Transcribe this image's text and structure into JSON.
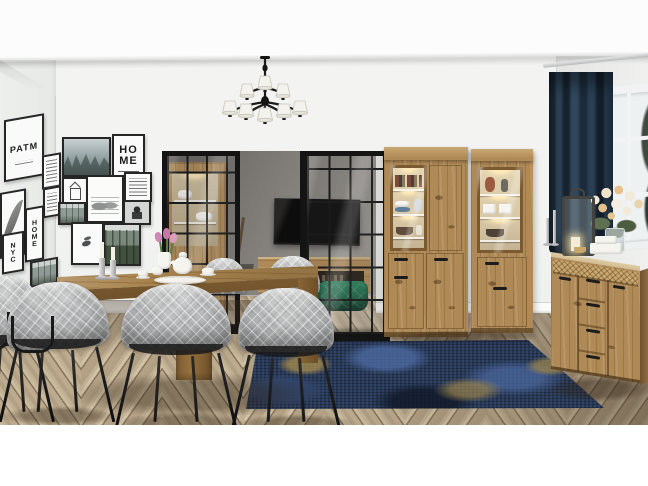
{
  "meta": {
    "description": "Interior product photo: dining room with oak furniture set, black-framed gallery wall, black chandelier with white shades, industrial glass partition to a TV room, dining table with tea set and grey quilted chairs, two lit oak display cabinets, oak chest of drawers with decor, navy velvet curtain, white window and blue vintage rug on herringbone oak floor.",
    "texts_visible": [
      "PATM",
      "HO ME",
      "H O M E",
      "N Y C"
    ]
  },
  "palette": {
    "ceiling": "#fcfcfc",
    "band": "#cfd0ce",
    "wall": "#f3f4f2",
    "wall_left": "#edefec",
    "wall_right": "#e9eae8",
    "back_wall": "#7d7a76",
    "back_floor": "#c0ac8c",
    "wood": "#b08a56",
    "wood_light": "#c8a873",
    "wood_dark": "#7c5a31",
    "wood_side": "#8f6c42",
    "wood_interior": "#d8c8a6",
    "table": "#96713d",
    "table_edge": "#7f5e33",
    "table_leg": "#6f5129",
    "floor_a": "#cbbb9e",
    "floor_b": "#b2a085",
    "floor_seam": "#5c4a36",
    "floor_shadow": "#8d7b64",
    "rug_base": "#253757",
    "rug_blue": "#4c69a0",
    "rug_mid": "#32476e",
    "rug_gold": "#ab8f4c",
    "rug_dark": "#101828",
    "chair_fabric": "#b6b7b8",
    "chair_shadow": "#8e8f92",
    "metal": "#1c1c1c",
    "curtain_a": "#2c4257",
    "curtain_b": "#15212d",
    "pouf": "#1e6c4b",
    "tv": "#0d0d0d",
    "shade": "#f4f2ec",
    "frame": "#262626",
    "paper": "#fafafa",
    "sketch": "#5a5d5e",
    "glass_sky": "#edf1f1",
    "tree": "#3e4a40",
    "flower_cream": "#f2ead9",
    "flower_peach": "#e6c08b",
    "leaf": "#5f7050",
    "led": "#ffe9b8",
    "porcelain": "#f6f4ef",
    "blue_bowl": "#5d7f9c",
    "terracotta": "#9c5a40",
    "book_red": "#7b4a38",
    "book_dark": "#4a4036"
  },
  "gallery": {
    "front_wall": [
      {
        "name": "print-misty-forest",
        "art": "mist",
        "x": 62,
        "y": 137,
        "w": 45,
        "h": 36
      },
      {
        "name": "print-home-typography",
        "art": "home",
        "text": "HO\nME",
        "x": 112,
        "y": 134,
        "w": 29,
        "h": 39
      },
      {
        "name": "print-house-sketch",
        "art": "house",
        "x": 62,
        "y": 177,
        "w": 22,
        "h": 24
      },
      {
        "name": "print-motorbike-sketch",
        "art": "sketch",
        "x": 86,
        "y": 175,
        "w": 34,
        "h": 44
      },
      {
        "name": "print-text-poster",
        "art": "lines",
        "x": 124,
        "y": 172,
        "w": 24,
        "h": 26
      },
      {
        "name": "print-forest-path",
        "art": "path",
        "x": 58,
        "y": 202,
        "w": 24,
        "h": 19
      },
      {
        "name": "print-portrait",
        "art": "portrait",
        "x": 123,
        "y": 200,
        "w": 24,
        "h": 21
      },
      {
        "name": "print-hummingbird",
        "art": "bird",
        "x": 71,
        "y": 222,
        "w": 29,
        "h": 39
      },
      {
        "name": "print-pine-forest",
        "art": "forest",
        "x": 103,
        "y": 223,
        "w": 34,
        "h": 39
      }
    ],
    "left_wall": [
      {
        "name": "print-runic-typography",
        "art": "typo",
        "text": "PATM",
        "x": 4,
        "y": 26,
        "w": 36,
        "h": 58
      },
      {
        "name": "print-quote",
        "art": "lines",
        "x": 42,
        "y": 68,
        "w": 15,
        "h": 30
      },
      {
        "name": "print-quote-2",
        "art": "lines",
        "x": 43,
        "y": 101,
        "w": 14,
        "h": 26
      },
      {
        "name": "print-feather",
        "art": "feather",
        "x": 0,
        "y": 98,
        "w": 22,
        "h": 62
      },
      {
        "name": "print-home-letters",
        "art": "letters",
        "text": "H\nO\nM\nE",
        "x": 25,
        "y": 118,
        "w": 15,
        "h": 50
      },
      {
        "name": "print-letters-nyc",
        "art": "letters",
        "text": "N\nY\nC",
        "x": 2,
        "y": 140,
        "w": 18,
        "h": 36
      },
      {
        "name": "print-photo-small",
        "art": "path",
        "x": 30,
        "y": 172,
        "w": 24,
        "h": 22
      }
    ]
  },
  "chairs": [
    {
      "name": "dining-chair-far-left",
      "kind": "side",
      "x": -26,
      "y": 276,
      "w": 72,
      "h": 148
    },
    {
      "name": "dining-chair-left",
      "kind": "side",
      "x": 2,
      "y": 282,
      "w": 110,
      "h": 142
    },
    {
      "name": "dining-chair-center",
      "kind": "back",
      "x": 117,
      "y": 284,
      "w": 118,
      "h": 150
    },
    {
      "name": "dining-chair-right",
      "kind": "back",
      "x": 235,
      "y": 288,
      "w": 102,
      "h": 146
    },
    {
      "name": "dining-chair-far-side-left",
      "kind": "shellonly",
      "x": 198,
      "y": 258,
      "w": 50,
      "h": 36
    },
    {
      "name": "dining-chair-far-side-right",
      "kind": "shellonly",
      "x": 264,
      "y": 256,
      "w": 58,
      "h": 40
    }
  ],
  "chandelier": {
    "upper_shades": 3,
    "lower_shades": 5,
    "arm_color": "#1b1b1b",
    "shade_color": "#f4f2ec"
  },
  "scene": {
    "objects": [
      "gallery wall of black framed prints",
      "black chandelier with white pleated shades",
      "industrial glass partition with black steel frame",
      "wall mounted TV in back room",
      "potted plant",
      "oak TV sideboard",
      "green velvet pouf",
      "oak dining table with silver candlesticks, tulips and white tea set",
      "grey quilted dining chairs with black metal legs",
      "wide oak display cabinet with lit glass door showing books, bowls and vases",
      "narrow oak display cabinet with lit glass door showing vases and gift boxes",
      "oak chest of drawers with rattan strip, lantern, candlesticks and rose bouquet",
      "navy velvet curtain on silver rod",
      "white window with trees outside",
      "distressed navy and gold rug",
      "herringbone oak parquet floor"
    ]
  }
}
